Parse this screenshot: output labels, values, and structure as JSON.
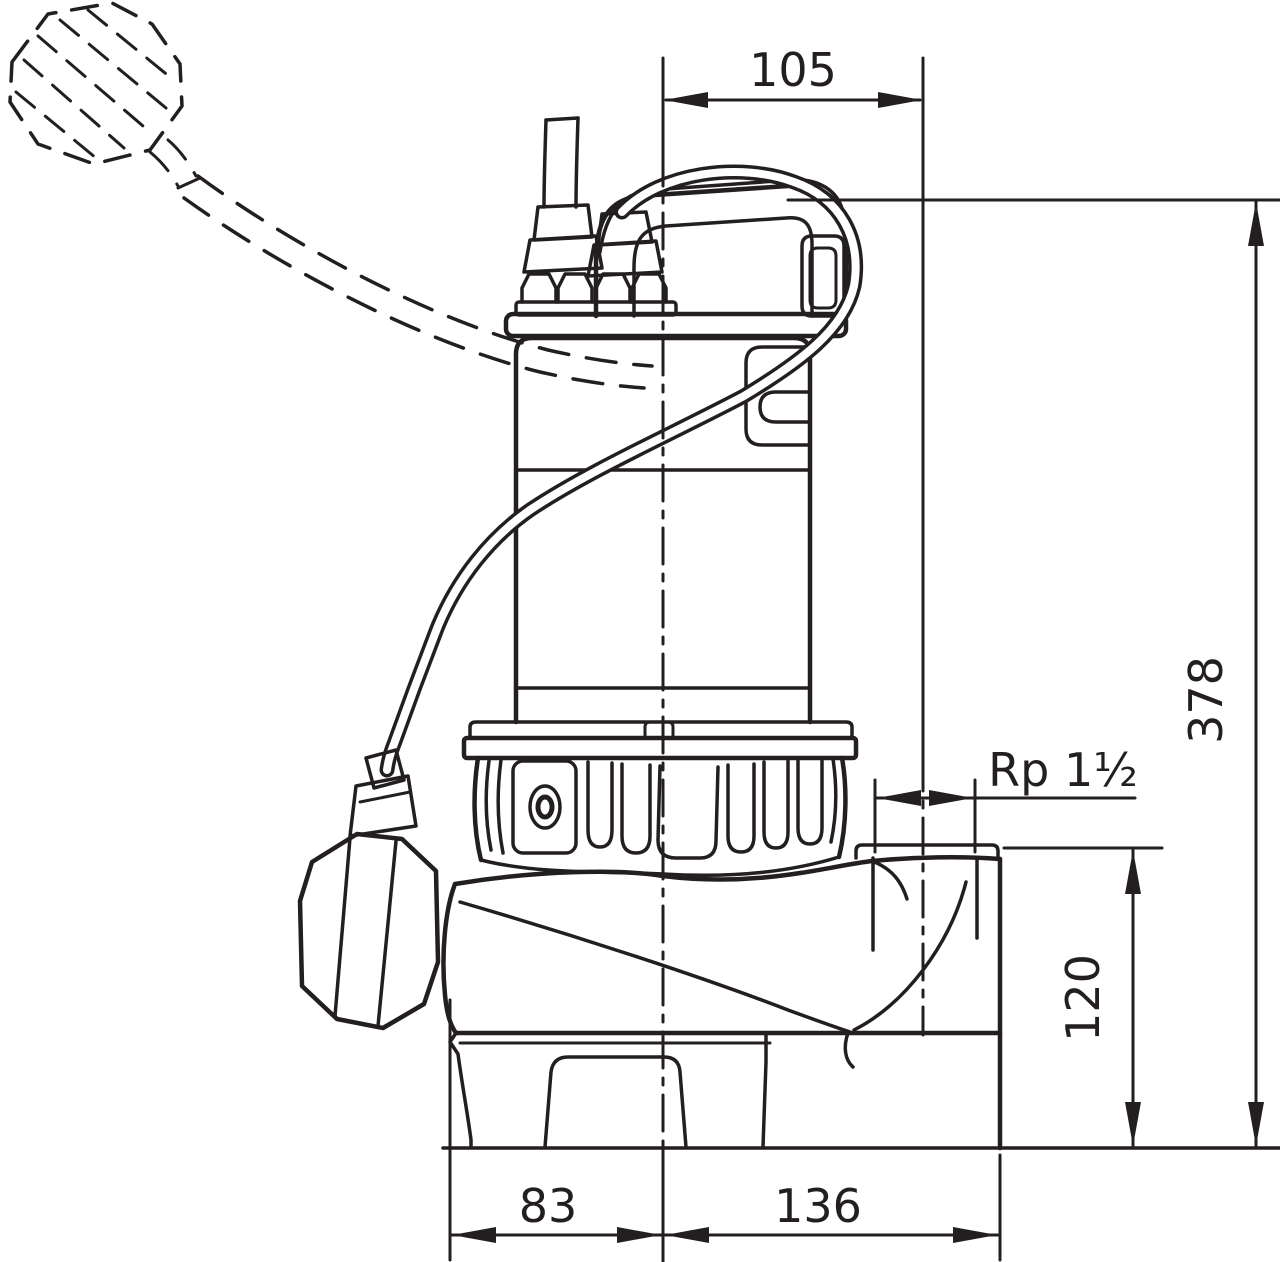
{
  "drawing": {
    "background_color": "#ffffff",
    "line_color": "#231f20",
    "dimensions": {
      "top_port_offset": "105",
      "overall_height": "378",
      "discharge_thread": "Rp 1½",
      "discharge_height": "120",
      "base_left_width": "83",
      "base_right_width": "136"
    }
  }
}
